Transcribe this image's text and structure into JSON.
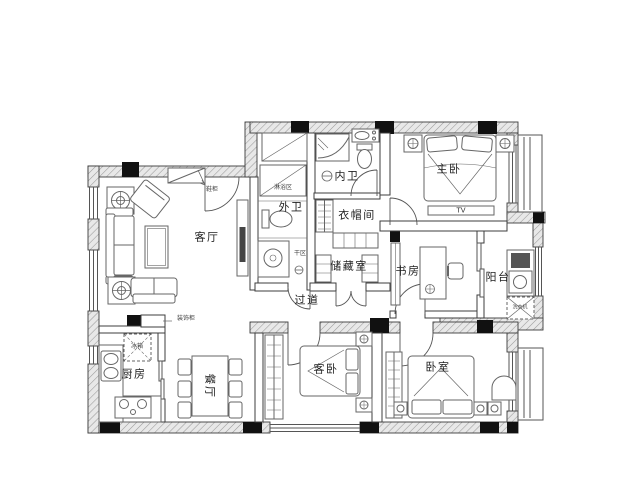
{
  "drawing": {
    "kind": "apartment-floor-plan",
    "colors": {
      "background": "#ffffff",
      "wall_hatch_bg": "#e8e8e8",
      "wall_hatch_line": "#9a9a9a",
      "wall_outline": "#3c3c3c",
      "column_fill": "#111111",
      "furniture_line": "#666666",
      "label_text": "#222222"
    }
  },
  "rooms": {
    "living": {
      "label": "客厅"
    },
    "kitchen": {
      "label": "厨房"
    },
    "dining": {
      "label": "餐厅"
    },
    "hallway": {
      "label": "过道"
    },
    "inner_bath": {
      "label": "内卫"
    },
    "outer_bath": {
      "label": "外卫"
    },
    "cloakroom": {
      "label": "衣帽间"
    },
    "storage": {
      "label": "储藏室"
    },
    "study": {
      "label": "书房"
    },
    "balcony": {
      "label": "阳台"
    },
    "master_bedroom": {
      "label": "主卧"
    },
    "guest_bedroom": {
      "label": "客卧"
    },
    "bedroom": {
      "label": "卧室"
    }
  },
  "annotations": {
    "tv": "TV",
    "shoe_cabinet": "鞋柜",
    "decor_cabinet": "装饰柜",
    "fridge": "冰箱",
    "shower_area": "淋浴区",
    "dry_area": "干区",
    "washer": "洗衣机"
  }
}
